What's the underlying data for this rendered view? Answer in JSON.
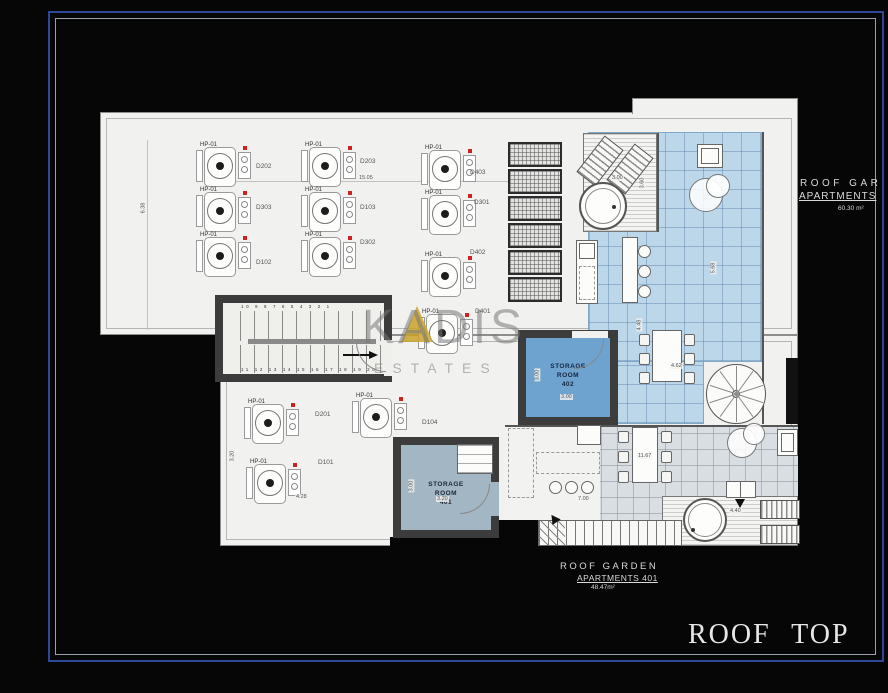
{
  "watermark": {
    "brand": "KADIS",
    "sub": "ESTATES"
  },
  "titles": {
    "roof_top": "ROOF TOP"
  },
  "right_label": {
    "line1": "ROOF GAR",
    "line2": "APARTMENTS",
    "area": "60.30 m²"
  },
  "bottom_label": {
    "line1": "ROOF GARDEN",
    "line2": "APARTMENTS 401",
    "area": "48.47m²"
  },
  "storage402": {
    "line1": "STORAGE",
    "line2": "ROOM",
    "line3": "402"
  },
  "storage401": {
    "line1": "STORAGE",
    "line2": "ROOM",
    "line3": "401"
  },
  "stairs": {
    "top_numbers": "10 9 8 7 6 5 4 3 2 1",
    "bottom_numbers": "11 12 13 14 15 16 17 18 19 20"
  },
  "solar_panels": {
    "count": 6
  },
  "hp_units": [
    {
      "label": "HP-01",
      "x": 196,
      "y": 145
    },
    {
      "label": "HP-01",
      "x": 301,
      "y": 145
    },
    {
      "label": "HP-01",
      "x": 421,
      "y": 148
    },
    {
      "label": "HP-01",
      "x": 196,
      "y": 190
    },
    {
      "label": "HP-01",
      "x": 301,
      "y": 190
    },
    {
      "label": "HP-01",
      "x": 421,
      "y": 193
    },
    {
      "label": "HP-01",
      "x": 196,
      "y": 235
    },
    {
      "label": "HP-01",
      "x": 301,
      "y": 235
    },
    {
      "label": "HP-01",
      "x": 421,
      "y": 255
    },
    {
      "label": "HP-01",
      "x": 418,
      "y": 312
    },
    {
      "label": "HP-01",
      "x": 244,
      "y": 402
    },
    {
      "label": "HP-01",
      "x": 352,
      "y": 396
    },
    {
      "label": "HP-01",
      "x": 246,
      "y": 462
    }
  ],
  "unit_tags": [
    {
      "text": "D202",
      "x": 256,
      "y": 163
    },
    {
      "text": "D203",
      "x": 360,
      "y": 158
    },
    {
      "text": "D403",
      "x": 470,
      "y": 169
    },
    {
      "text": "D303",
      "x": 256,
      "y": 204
    },
    {
      "text": "D103",
      "x": 360,
      "y": 204
    },
    {
      "text": "D301",
      "x": 474,
      "y": 199
    },
    {
      "text": "D102",
      "x": 256,
      "y": 259
    },
    {
      "text": "D302",
      "x": 360,
      "y": 239
    },
    {
      "text": "D402",
      "x": 470,
      "y": 249
    },
    {
      "text": "D401",
      "x": 475,
      "y": 308
    },
    {
      "text": "D201",
      "x": 315,
      "y": 411
    },
    {
      "text": "D104",
      "x": 422,
      "y": 419
    },
    {
      "text": "D101",
      "x": 318,
      "y": 459
    }
  ],
  "dimensions": [
    {
      "text": "6.38",
      "x": 137,
      "y": 205,
      "rot": "v"
    },
    {
      "text": "15.05",
      "x": 358,
      "y": 175,
      "rot": "h"
    },
    {
      "text": "3.20",
      "x": 226,
      "y": 453,
      "rot": "v"
    },
    {
      "text": "4.28",
      "x": 295,
      "y": 494,
      "rot": "h"
    },
    {
      "text": "3.00",
      "x": 611,
      "y": 175,
      "rot": "h"
    },
    {
      "text": "3.60",
      "x": 636,
      "y": 180,
      "rot": "v"
    },
    {
      "text": "5.68",
      "x": 707,
      "y": 265,
      "rot": "v"
    },
    {
      "text": "4.48",
      "x": 633,
      "y": 322,
      "rot": "v"
    },
    {
      "text": "4.62",
      "x": 670,
      "y": 363,
      "rot": "h"
    },
    {
      "text": "11.67",
      "x": 637,
      "y": 453,
      "rot": "h"
    },
    {
      "text": "7.00",
      "x": 577,
      "y": 496,
      "rot": "h"
    },
    {
      "text": "4.40",
      "x": 729,
      "y": 508,
      "rot": "h"
    },
    {
      "text": "3.00",
      "x": 560,
      "y": 394,
      "rot": "h"
    },
    {
      "text": "3.00",
      "x": 531,
      "y": 372,
      "rot": "v"
    },
    {
      "text": "3.20",
      "x": 436,
      "y": 496,
      "rot": "h"
    },
    {
      "text": "3.00",
      "x": 405,
      "y": 483,
      "rot": "v"
    }
  ],
  "colors": {
    "frame_blue": "#2e4796",
    "tile_blue": "#bcd6ea",
    "tile_gray": "#d9dee3",
    "storage_blue": "#6ea3d0",
    "storage_gray": "#a3b6c4",
    "wall": "#3c3c3c",
    "gold": "#c9a22a"
  }
}
